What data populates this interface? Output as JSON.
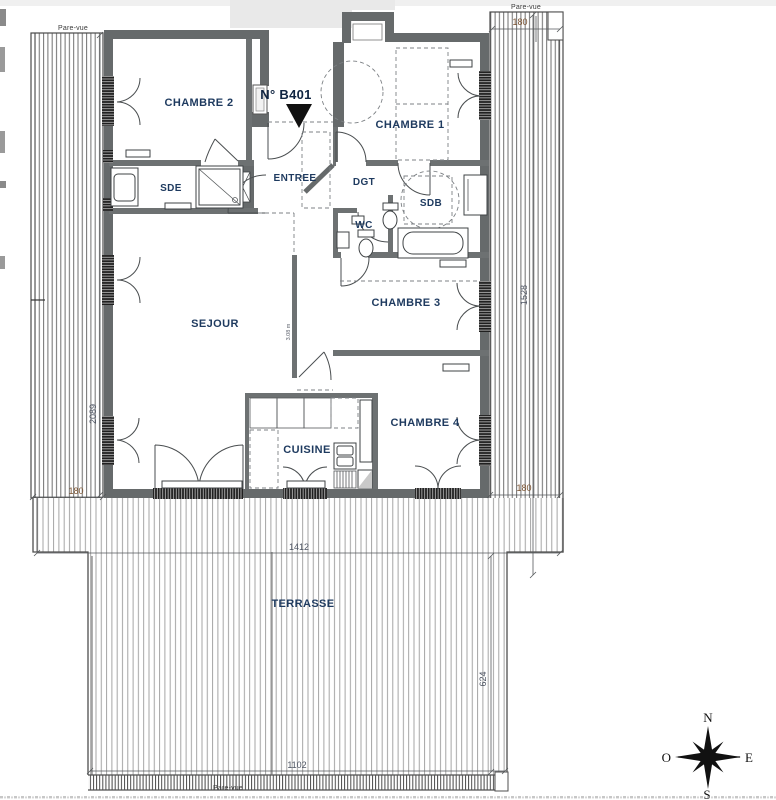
{
  "title": {
    "unit_number": "N° B401"
  },
  "rooms": {
    "chambre1": "CHAMBRE 1",
    "chambre2": "CHAMBRE 2",
    "chambre3": "CHAMBRE 3",
    "chambre4": "CHAMBRE 4",
    "sejour": "SEJOUR",
    "cuisine": "CUISINE",
    "entree": "ENTREE",
    "dgt": "DGT",
    "sde": "SDE",
    "sdb": "SDB",
    "wc": "WC",
    "terrasse": "TERRASSE"
  },
  "dimensions": {
    "screen_top_right": "180",
    "right_side": "1528",
    "left_side": "2089",
    "bottom_left": "180",
    "bottom_right": "180",
    "terrace_width": "1412",
    "terrace_depth": "624",
    "terrace_bottom": "1102",
    "corridor": "3.08 m"
  },
  "screens": {
    "top_left": "Pare-vue",
    "top_right": "Pare-vue",
    "bottom": "Pare-vue"
  },
  "compass": {
    "north": "N",
    "east": "E",
    "south": "S",
    "west": "O"
  },
  "colors": {
    "wall": "#666a6b",
    "label": "#1e3a5f",
    "dimension": "#4e5563",
    "dimension_alt": "#7a5230",
    "hatch": "#9b9b9b"
  }
}
